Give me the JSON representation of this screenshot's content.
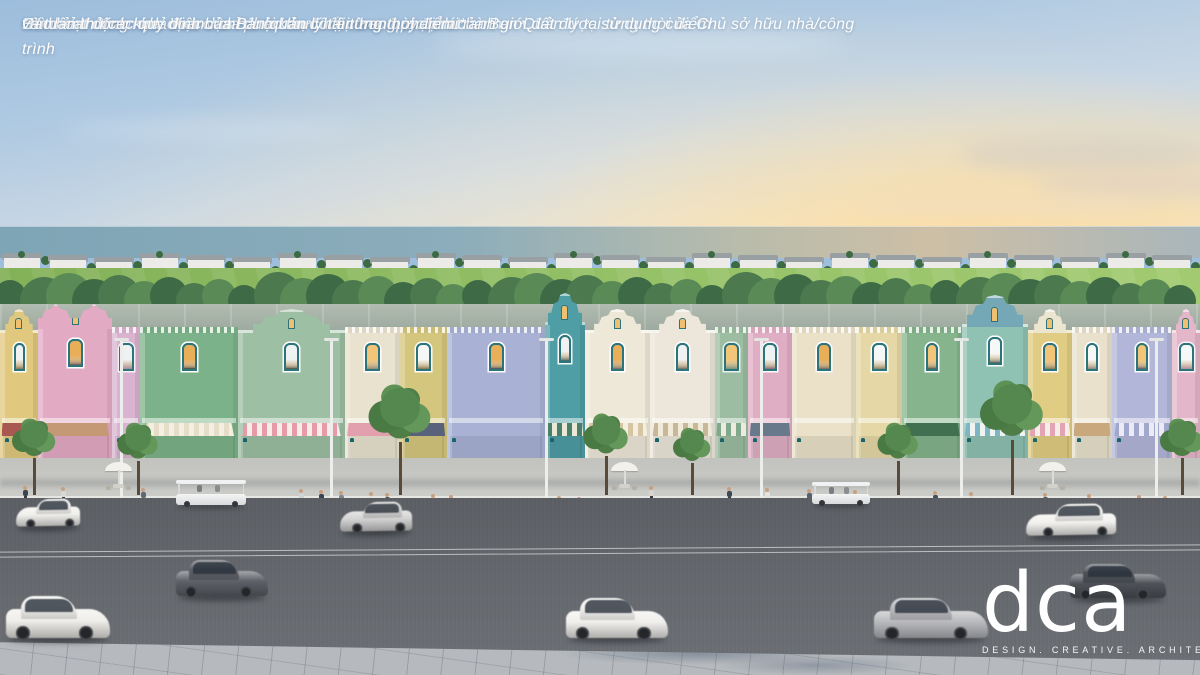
{
  "disclaimer": {
    "lines": [
      "*Hình ảnh tham khảo và chưa phải bản cuối cùng được phát hành",
      "Hình ảnh minh họa. Việc vận hành khu đô thị theo quy định của Ban Quản lý tại từng thời điểm",
      "Các hoạt động kinh doanh chỉ được thực hiện trong phạm vi ranh giới đất được sử dụng của Chủ sở hữu nhà/công trình",
      "và tuân thủ các quy định của Ban quản lý tại từng thời điểm.*"
    ]
  },
  "logo": {
    "name": "dca",
    "tagline": "DESIGN. CREATIVE. ARCHITECTURE"
  },
  "scene": {
    "palette": {
      "window_frame": "#2b747b",
      "shop_frame": "#1a656c",
      "window_glow": [
        "#f3c578",
        "#eff2f3",
        "#e9ae58",
        "#f6f7f7"
      ],
      "sky_top": "#9cbddc",
      "sky_horizon": "#efe2c4",
      "road": "#63676c",
      "sidewalk": "#c6c7c3",
      "grass": "#95c167"
    },
    "villas": {
      "count": 26,
      "body": "#ecebe7",
      "roof": "#99a0a4",
      "palm": "#3c6a42"
    },
    "treeline": {
      "count": 46,
      "colors": [
        "#3e6b46",
        "#4c7a4e",
        "#5a8a55"
      ]
    },
    "bunkers": [
      {
        "x": 52,
        "y": 292,
        "w": 74,
        "h": 10
      },
      {
        "x": 136,
        "y": 286,
        "w": 46,
        "h": 8
      },
      {
        "x": 272,
        "y": 298,
        "w": 62,
        "h": 9
      },
      {
        "x": 844,
        "y": 310,
        "w": 180,
        "h": 11
      }
    ],
    "golfers": [
      {
        "x": 183,
        "y": 287
      },
      {
        "x": 191,
        "y": 289
      },
      {
        "x": 199,
        "y": 287
      }
    ],
    "buildings": [
      {
        "w": 38,
        "color": "#e0c87e",
        "gable": "dutch",
        "awning": {
          "type": "solid",
          "c1": "#a85850"
        }
      },
      {
        "w": 74,
        "color": "#e3aac4",
        "gable": "dutch2",
        "h": 154,
        "awning": {
          "type": "solid",
          "c1": "#c49a76"
        }
      },
      {
        "w": 28,
        "color": "#d9b3cf",
        "gable": "flat",
        "awning": {
          "type": "none"
        }
      },
      {
        "w": 98,
        "color": "#7cb289",
        "gable": "flat",
        "awning": {
          "type": "stripe",
          "c1": "#e6ddc8",
          "c2": "#f4efe2"
        }
      },
      {
        "w": 107,
        "color": "#9dbfa3",
        "gable": "dutch",
        "awning": {
          "type": "stripe",
          "c1": "#e79aa8",
          "c2": "#f6ece8"
        }
      },
      {
        "w": 55,
        "color": "#e9e2cf",
        "gable": "flat",
        "awning": {
          "type": "solid",
          "c1": "#e2a0ae"
        }
      },
      {
        "w": 47,
        "color": "#d5c67d",
        "gable": "flat",
        "awning": {
          "type": "solid",
          "c1": "#58627a"
        }
      },
      {
        "w": 98,
        "color": "#a9b2d5",
        "gable": "flat",
        "awning": {
          "type": "none"
        }
      },
      {
        "w": 40,
        "color": "#4f9da5",
        "gable": "dutchTall",
        "h": 158,
        "awning": {
          "type": "stripe",
          "c1": "#47806a",
          "c2": "#ece8d8"
        }
      },
      {
        "w": 65,
        "color": "#eee8d8",
        "gable": "dutch",
        "awning": {
          "type": "stripe",
          "c1": "#d6c5a2",
          "c2": "#f4eede"
        }
      },
      {
        "w": 65,
        "color": "#ece7da",
        "gable": "dutch",
        "awning": {
          "type": "stripe",
          "c1": "#c9b897",
          "c2": "#f0ead9"
        }
      },
      {
        "w": 33,
        "color": "#9cbda1",
        "gable": "flat",
        "awning": {
          "type": "stripe",
          "c1": "#7fa98a",
          "c2": "#eeeadf"
        }
      },
      {
        "w": 44,
        "color": "#e0aec4",
        "gable": "flat",
        "awning": {
          "type": "solid",
          "c1": "#68798c"
        }
      },
      {
        "w": 64,
        "color": "#eae1c8",
        "gable": "flat",
        "awning": {
          "type": "none"
        }
      },
      {
        "w": 46,
        "color": "#e5d8a6",
        "gable": "flat",
        "awning": {
          "type": "none"
        }
      },
      {
        "w": 60,
        "color": "#85b48d",
        "gable": "flat",
        "awning": {
          "type": "solid",
          "c1": "#40704f"
        }
      },
      {
        "w": 66,
        "color": "#8fc2b2",
        "gable": "dutchTall",
        "gableColor": "#74a8b6",
        "h": 156,
        "awning": {
          "type": "stripe",
          "c1": "#7cb6c6",
          "c2": "#f0f4f0"
        }
      },
      {
        "w": 44,
        "color": "#e0cc82",
        "gable": "dutch",
        "gableColor": "#ece5cf",
        "awning": {
          "type": "stripe",
          "c1": "#e2a4b4",
          "c2": "#f6eee6"
        }
      },
      {
        "w": 40,
        "color": "#e9e1cc",
        "gable": "flat",
        "awning": {
          "type": "solid",
          "c1": "#caa87e"
        }
      },
      {
        "w": 60,
        "color": "#b2b6d8",
        "gable": "flat",
        "awning": {
          "type": "stripe",
          "c1": "#a0a8cc",
          "c2": "#eceaf4"
        }
      },
      {
        "w": 28,
        "color": "#e4b6c9",
        "gable": "dutch",
        "awning": {
          "type": "none"
        }
      }
    ],
    "lamps": [
      {
        "x": 120
      },
      {
        "x": 330
      },
      {
        "x": 545
      },
      {
        "x": 760
      },
      {
        "x": 960
      },
      {
        "x": 1155
      }
    ],
    "trees": [
      {
        "x": 34,
        "s": 0.8
      },
      {
        "x": 138,
        "s": 0.75
      },
      {
        "x": 400,
        "s": 1.15
      },
      {
        "x": 606,
        "s": 0.85
      },
      {
        "x": 692,
        "s": 0.7
      },
      {
        "x": 898,
        "s": 0.75
      },
      {
        "x": 1012,
        "s": 1.2
      },
      {
        "x": 1182,
        "s": 0.8
      }
    ],
    "parasols": [
      {
        "x": 118
      },
      {
        "x": 624
      },
      {
        "x": 1052
      }
    ],
    "people": [
      {
        "x": 22,
        "c": "#3a4450"
      },
      {
        "x": 60,
        "c": "#d8d8d4"
      },
      {
        "x": 140,
        "c": "#5a6a74"
      },
      {
        "x": 298,
        "c": "#cfd4d6"
      },
      {
        "x": 318,
        "c": "#384652"
      },
      {
        "x": 338,
        "c": "#7c8890"
      },
      {
        "x": 368,
        "c": "#e4e2dc"
      },
      {
        "x": 384,
        "c": "#46525e"
      },
      {
        "x": 430,
        "c": "#d0ccc4"
      },
      {
        "x": 448,
        "c": "#39474f"
      },
      {
        "x": 556,
        "c": "#e2e0da"
      },
      {
        "x": 576,
        "c": "#4a5862"
      },
      {
        "x": 648,
        "c": "#d8d5cf"
      },
      {
        "x": 726,
        "c": "#3c4a54"
      },
      {
        "x": 764,
        "c": "#e6e3dd"
      },
      {
        "x": 806,
        "c": "#55626c"
      },
      {
        "x": 852,
        "c": "#dad7d1"
      },
      {
        "x": 932,
        "c": "#42505a"
      },
      {
        "x": 968,
        "c": "#e0ddd7"
      },
      {
        "x": 1042,
        "c": "#4e5a64"
      },
      {
        "x": 1086,
        "c": "#d6d3cd"
      },
      {
        "x": 1136,
        "c": "#3e4c56"
      },
      {
        "x": 1162,
        "c": "#cfd2d4"
      }
    ],
    "carts": [
      {
        "x": 176,
        "y": 480,
        "w": 70,
        "h": 27
      },
      {
        "x": 812,
        "y": 482,
        "w": 58,
        "h": 24
      }
    ],
    "cars": [
      {
        "x": 16,
        "y": 498,
        "w": 64,
        "h": 30,
        "color": "#f0efec",
        "dir": "left"
      },
      {
        "x": 340,
        "y": 501,
        "w": 72,
        "h": 32,
        "color": "#d3d2d2",
        "dir": "left"
      },
      {
        "x": 1026,
        "y": 503,
        "w": 90,
        "h": 34,
        "color": "#f2f1ee",
        "dir": "left"
      },
      {
        "x": 176,
        "y": 558,
        "w": 92,
        "h": 40,
        "color": "#5e6168",
        "dir": "right"
      },
      {
        "x": 1070,
        "y": 562,
        "w": 96,
        "h": 38,
        "color": "#4e5258",
        "dir": "right"
      },
      {
        "x": 6,
        "y": 594,
        "w": 104,
        "h": 46,
        "color": "#efeeea",
        "dir": "right"
      },
      {
        "x": 566,
        "y": 596,
        "w": 102,
        "h": 44,
        "color": "#f1f0ed",
        "dir": "right"
      },
      {
        "x": 874,
        "y": 596,
        "w": 114,
        "h": 44,
        "color": "#b9babe",
        "dir": "right"
      }
    ]
  }
}
